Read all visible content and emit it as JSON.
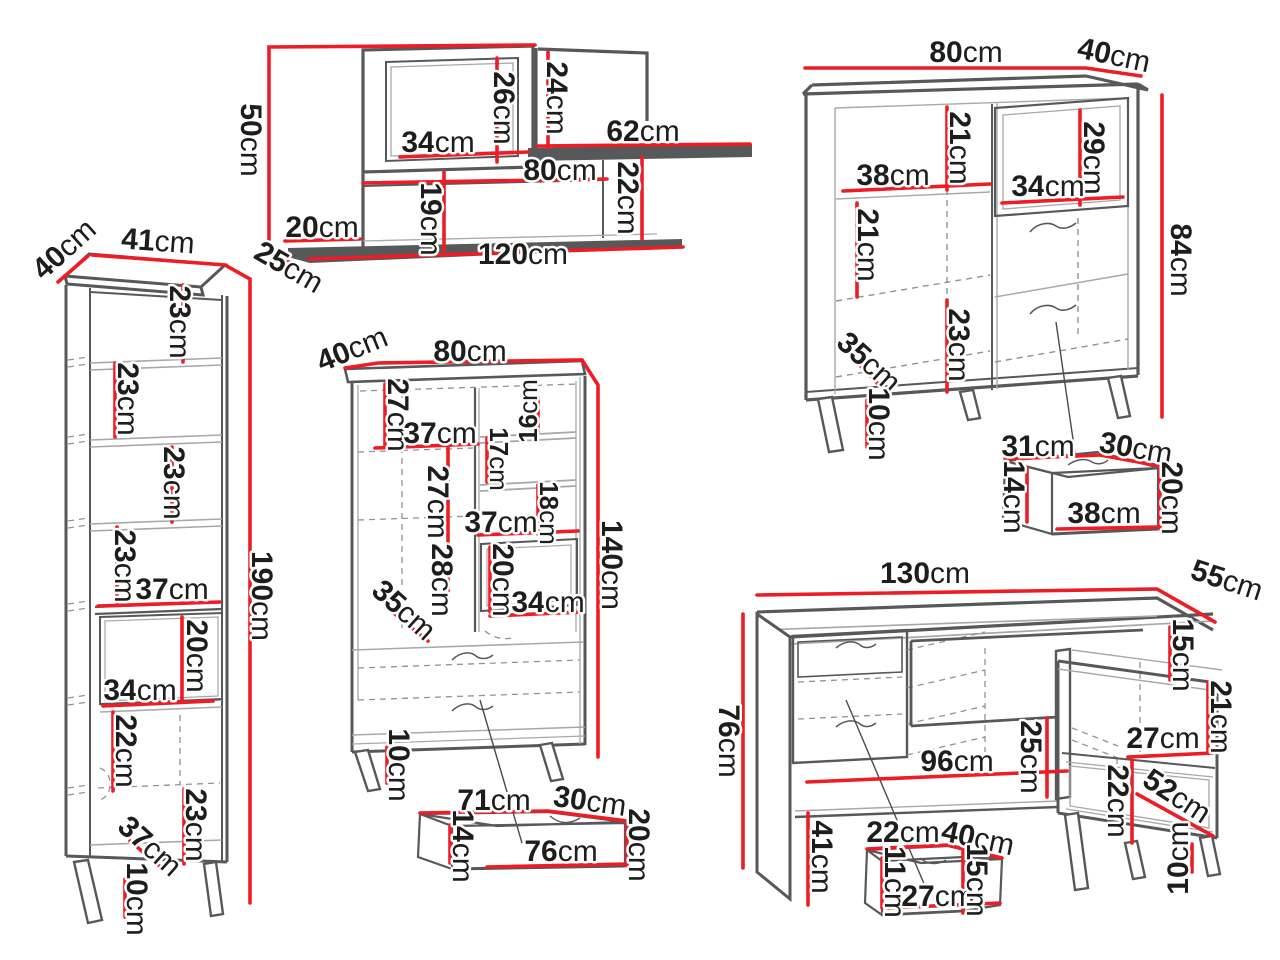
{
  "unit_label": "cm",
  "colors": {
    "dimension_red": "#ee1c24",
    "outline_gray": "#57585a",
    "text_black": "#1d1d1b",
    "background": "#ffffff"
  },
  "pieces": {
    "wall_unit": {
      "dims": [
        {
          "v": "50",
          "u": "cm"
        },
        {
          "v": "26",
          "u": "cm"
        },
        {
          "v": "24",
          "u": "cm"
        },
        {
          "v": "34",
          "u": "cm"
        },
        {
          "v": "62",
          "u": "cm"
        },
        {
          "v": "80",
          "u": "cm"
        },
        {
          "v": "19",
          "u": "cm"
        },
        {
          "v": "22",
          "u": "cm"
        },
        {
          "v": "20",
          "u": "cm"
        },
        {
          "v": "120",
          "u": "cm"
        },
        {
          "v": "25",
          "u": "cm"
        }
      ]
    },
    "sideboard": {
      "dims": [
        {
          "v": "80",
          "u": "cm"
        },
        {
          "v": "40",
          "u": "cm"
        },
        {
          "v": "84",
          "u": "cm"
        },
        {
          "v": "21",
          "u": "cm"
        },
        {
          "v": "38",
          "u": "cm"
        },
        {
          "v": "29",
          "u": "cm"
        },
        {
          "v": "34",
          "u": "cm"
        },
        {
          "v": "21",
          "u": "cm"
        },
        {
          "v": "23",
          "u": "cm"
        },
        {
          "v": "35",
          "u": "cm"
        },
        {
          "v": "10",
          "u": "cm"
        }
      ]
    },
    "sideboard_drawer": {
      "dims": [
        {
          "v": "31",
          "u": "cm"
        },
        {
          "v": "30",
          "u": "cm"
        },
        {
          "v": "14",
          "u": "cm"
        },
        {
          "v": "20",
          "u": "cm"
        },
        {
          "v": "38",
          "u": "cm"
        }
      ]
    },
    "bookcase": {
      "dims": [
        {
          "v": "40",
          "u": "cm"
        },
        {
          "v": "41",
          "u": "cm"
        },
        {
          "v": "190",
          "u": "cm"
        },
        {
          "v": "23",
          "u": "cm"
        },
        {
          "v": "23",
          "u": "cm"
        },
        {
          "v": "23",
          "u": "cm"
        },
        {
          "v": "23",
          "u": "cm"
        },
        {
          "v": "37",
          "u": "cm"
        },
        {
          "v": "20",
          "u": "cm"
        },
        {
          "v": "34",
          "u": "cm"
        },
        {
          "v": "22",
          "u": "cm"
        },
        {
          "v": "23",
          "u": "cm"
        },
        {
          "v": "37",
          "u": "cm"
        },
        {
          "v": "10",
          "u": "cm"
        }
      ]
    },
    "cabinet": {
      "dims": [
        {
          "v": "40",
          "u": "cm"
        },
        {
          "v": "80",
          "u": "cm"
        },
        {
          "v": "140",
          "u": "cm"
        },
        {
          "v": "27",
          "u": "cm"
        },
        {
          "v": "37",
          "u": "cm"
        },
        {
          "v": "27",
          "u": "cm"
        },
        {
          "v": "28",
          "u": "cm"
        },
        {
          "v": "16",
          "u": "cm"
        },
        {
          "v": "17",
          "u": "cm"
        },
        {
          "v": "18",
          "u": "cm"
        },
        {
          "v": "37",
          "u": "cm"
        },
        {
          "v": "20",
          "u": "cm"
        },
        {
          "v": "34",
          "u": "cm"
        },
        {
          "v": "35",
          "u": "cm"
        },
        {
          "v": "10",
          "u": "cm"
        }
      ]
    },
    "cabinet_drawer": {
      "dims": [
        {
          "v": "71",
          "u": "cm"
        },
        {
          "v": "30",
          "u": "cm"
        },
        {
          "v": "14",
          "u": "cm"
        },
        {
          "v": "76",
          "u": "cm"
        },
        {
          "v": "20",
          "u": "cm"
        }
      ]
    },
    "desk": {
      "dims": [
        {
          "v": "130",
          "u": "cm"
        },
        {
          "v": "55",
          "u": "cm"
        },
        {
          "v": "76",
          "u": "cm"
        },
        {
          "v": "15",
          "u": "cm"
        },
        {
          "v": "21",
          "u": "cm"
        },
        {
          "v": "27",
          "u": "cm"
        },
        {
          "v": "22",
          "u": "cm"
        },
        {
          "v": "52",
          "u": "cm"
        },
        {
          "v": "96",
          "u": "cm"
        },
        {
          "v": "25",
          "u": "cm"
        },
        {
          "v": "41",
          "u": "cm"
        },
        {
          "v": "10",
          "u": "cm"
        }
      ]
    },
    "desk_drawer": {
      "dims": [
        {
          "v": "22",
          "u": "cm"
        },
        {
          "v": "40",
          "u": "cm"
        },
        {
          "v": "11",
          "u": "cm"
        },
        {
          "v": "27",
          "u": "cm"
        },
        {
          "v": "15",
          "u": "cm"
        }
      ]
    }
  }
}
